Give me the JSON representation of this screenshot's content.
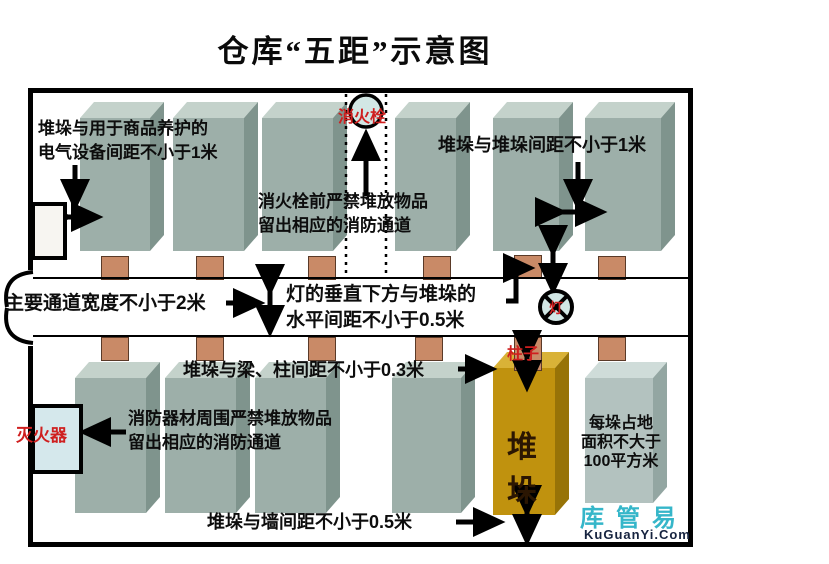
{
  "title": "仓库“五距”示意图",
  "annotations": {
    "electrical": {
      "line1": "堆垛与用于商品养护的",
      "line2": "电气设备间距不小于1米"
    },
    "stack_gap": "堆垛与堆垛间距不小于1米",
    "hydrant_front": {
      "line1": "消火栓前严禁堆放物品",
      "line2": "留出相应的消防通道"
    },
    "main_aisle": "主要通道宽度不小于2米",
    "lamp_distance": {
      "line1": "灯的垂直下方与堆垛的",
      "line2": "水平间距不小于0.5米"
    },
    "beam_column": "堆垛与梁、柱间距不小于0.3米",
    "fire_equipment": {
      "line1": "消防器材周围严禁堆放物品",
      "line2": "留出相应的消防通道"
    },
    "area_limit": {
      "line1": "每垛占地",
      "line2": "面积不大于",
      "line3": "100平方米"
    },
    "wall_gap": "堆垛与墙间距不小于0.5米"
  },
  "labels": {
    "hydrant": "消火栓",
    "lamp": "灯",
    "column": "柱子",
    "extinguisher": "灭火器",
    "pile": "堆垛"
  },
  "watermark": {
    "name": "库管易",
    "url": "KuGuanYi.Com"
  },
  "colors": {
    "stack_front": "#9dafa9",
    "stack_top": "#c4d2cb",
    "stack_side": "#7f948d",
    "pile_front": "#c0920e",
    "pile_top": "#d9b237",
    "pile_side": "#977307",
    "column_base": "#c98a67",
    "red_label": "#cf1f1f",
    "extinguisher_fill": "#d5e8ec",
    "watermark_teal": "#35b6c9",
    "watermark_dark": "#16233f"
  }
}
